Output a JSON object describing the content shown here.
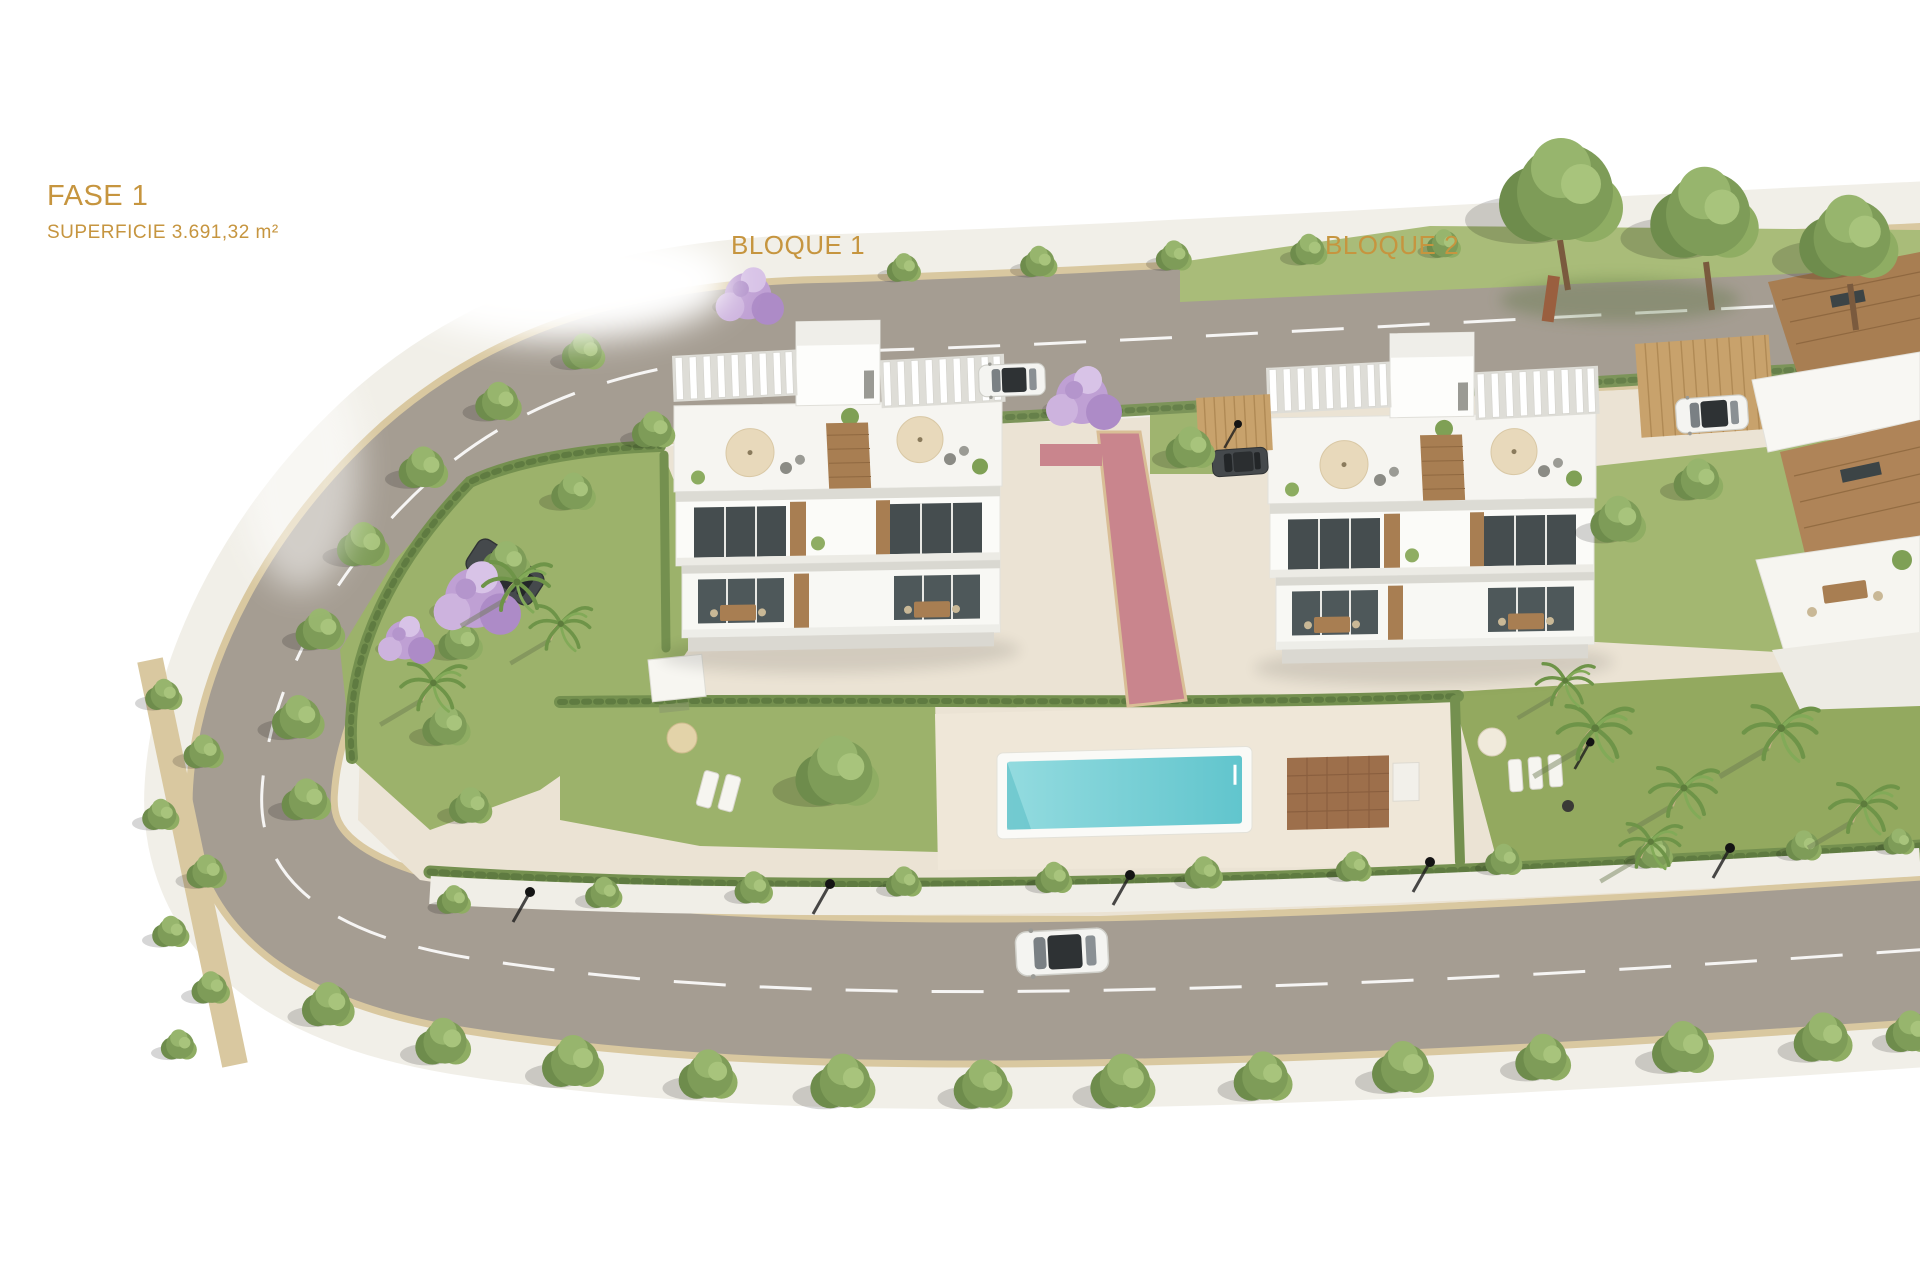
{
  "annotations": {
    "phase": {
      "title": "FASE 1",
      "surface_label": "SUPERFICIE 3.691,32 m²"
    },
    "blocks": [
      {
        "label": "BLOQUE 1"
      },
      {
        "label": "BLOQUE 2"
      }
    ],
    "text_color": "#C6953F"
  },
  "scene": {
    "palette": {
      "background": "#FFFFFF",
      "road_asphalt": "#A59D92",
      "sidewalk": "#F1EFE8",
      "curb_sand": "#D9C8A0",
      "interior_paving": "#EBE3D4",
      "pool_terrace": "#EFE7D8",
      "lawn": "#9CB26B",
      "lawn_dark": "#93A95F",
      "hedge": "#74904F",
      "pool_water": "#7BCED5",
      "pool_deck_wood": "#9D6F4B",
      "red_path": "#C9858D",
      "building_white": "#FAFAF7",
      "wood_accent": "#A87E52",
      "window_glass": "#454D4F",
      "tree_green": "#7E9C58",
      "jacaranda_purple": "#BFA0D4",
      "umbrella_tan": "#E8D9BB"
    }
  }
}
